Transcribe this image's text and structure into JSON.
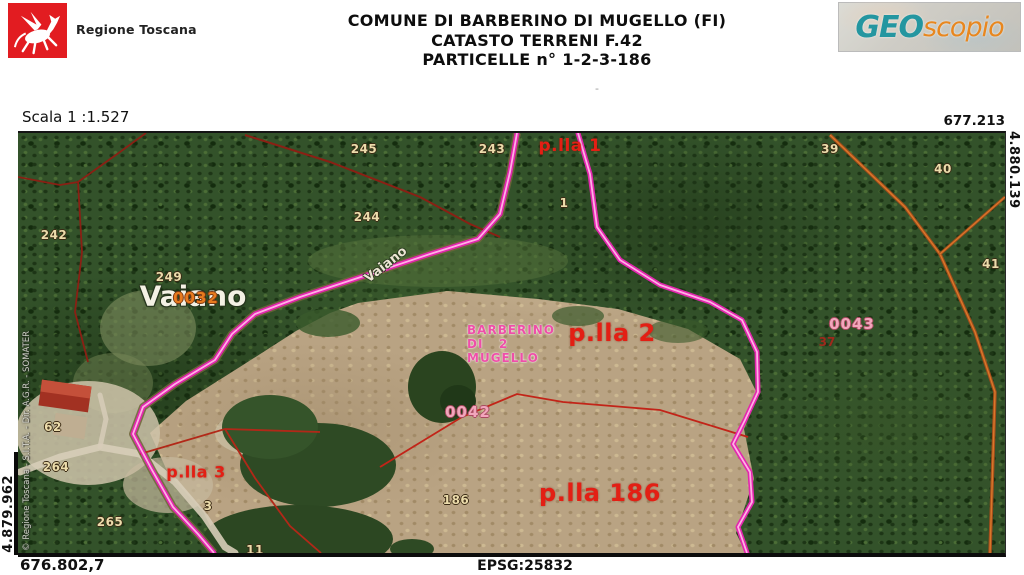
{
  "header": {
    "agency": "Regione Toscana",
    "title_line1": "COMUNE DI BARBERINO DI MUGELLO (FI)",
    "title_line2": "CATASTO TERRENI F.42",
    "title_line3": "PARTICELLE n° 1-2-3-186",
    "brand_geo": "GEO",
    "brand_scopio": "scopio",
    "small_mark": "-"
  },
  "frame": {
    "scale_label": "Scala 1 :1.527",
    "coord_top_right": "677.213",
    "coord_right_vertical": "4.880.139",
    "coord_left_vertical": "4.879.962",
    "coord_bottom_left": "676.802,7",
    "epsg": "EPSG:25832"
  },
  "map": {
    "copyright": "© Regione Toscana - S.I.T.A. - Dir. A.G.R. - SOMATER",
    "place_label": "Vaiano",
    "road_label": "Vaiano",
    "comune_watermark": [
      "BARBERINO",
      "DI   2",
      "MUGELLO"
    ],
    "annotations": {
      "highlights": [
        {
          "text": "p.lla 1",
          "x": 552,
          "y": 13,
          "size": 17
        },
        {
          "text": "p.lla 2",
          "x": 594,
          "y": 200,
          "size": 24
        },
        {
          "text": "p.lla 186",
          "x": 582,
          "y": 360,
          "size": 24
        },
        {
          "text": "p.lla 3",
          "x": 178,
          "y": 339,
          "size": 16
        }
      ],
      "parcel_numbers": [
        {
          "text": "245",
          "x": 346,
          "y": 16
        },
        {
          "text": "243",
          "x": 474,
          "y": 16
        },
        {
          "text": "244",
          "x": 349,
          "y": 84
        },
        {
          "text": "242",
          "x": 36,
          "y": 102
        },
        {
          "text": "249",
          "x": 151,
          "y": 144
        },
        {
          "text": "39",
          "x": 812,
          "y": 16
        },
        {
          "text": "40",
          "x": 925,
          "y": 36
        },
        {
          "text": "41",
          "x": 973,
          "y": 131
        },
        {
          "text": "1",
          "x": 546,
          "y": 70
        },
        {
          "text": "3",
          "x": 190,
          "y": 373
        },
        {
          "text": "11",
          "x": 237,
          "y": 417
        },
        {
          "text": "186",
          "x": 438,
          "y": 367
        },
        {
          "text": "265",
          "x": 92,
          "y": 389
        },
        {
          "text": "264",
          "x": 38,
          "y": 334
        },
        {
          "text": "62",
          "x": 35,
          "y": 294
        }
      ],
      "dark_numbers": [
        {
          "text": "37",
          "x": 809,
          "y": 209
        }
      ],
      "sheet_numbers": [
        {
          "text": "0032",
          "x": 178,
          "y": 165,
          "tone": "orange"
        },
        {
          "text": "0042",
          "x": 450,
          "y": 279,
          "tone": "pink"
        },
        {
          "text": "0043",
          "x": 834,
          "y": 191,
          "tone": "pink"
        }
      ]
    }
  },
  "colors": {
    "logo-red": "#e21c21",
    "brand-teal": "#2496a0",
    "brand-orange": "#e8871f",
    "highlight-pink": "#e326ae",
    "parcel-red": "#e31f14",
    "number-beige": "#ecdcab",
    "sheet-orange": "#e87b1e",
    "sheet-pink": "#f2a6bc"
  }
}
